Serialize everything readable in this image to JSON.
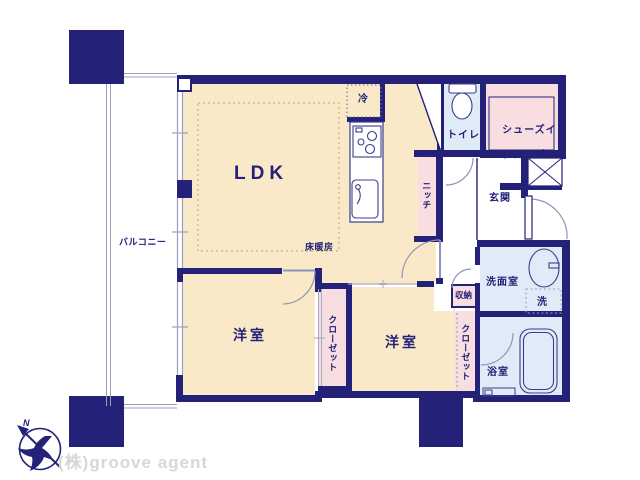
{
  "plan": {
    "rooms": {
      "ldk": {
        "label": "LDK"
      },
      "floor_heating": {
        "label": "床暖房"
      },
      "refrigerator": {
        "label": "冷"
      },
      "balcony": {
        "label": "バルコニー"
      },
      "bedroom_left": {
        "label": "洋室"
      },
      "bedroom_right": {
        "label": "洋室"
      },
      "closet_left": {
        "label": "クローゼット"
      },
      "closet_right": {
        "label": "クローゼット"
      },
      "storage": {
        "label": "収納"
      },
      "niche": {
        "label": "ニッチ"
      },
      "toilet": {
        "label": "トイレ"
      },
      "shoe_closet": {
        "line1": "シューズイン",
        "line2": "クローゼット"
      },
      "entrance": {
        "label": "玄関"
      },
      "washroom": {
        "label": "洗面室"
      },
      "washer": {
        "label": "洗"
      },
      "bathroom": {
        "label": "浴室"
      }
    },
    "compass": {
      "north_label": "N"
    },
    "watermark": {
      "text": "(株)groove agent"
    },
    "colors": {
      "wall_navy": "#232178",
      "room_cream": "#f9e9c8",
      "closet_pink": "#f8dee1",
      "wet_blue": "#dfecf7",
      "window_gray": "#9aa0bc",
      "heating_dash_tan": "#d2ae72",
      "watermark_gray": "#d7d7d7"
    }
  }
}
